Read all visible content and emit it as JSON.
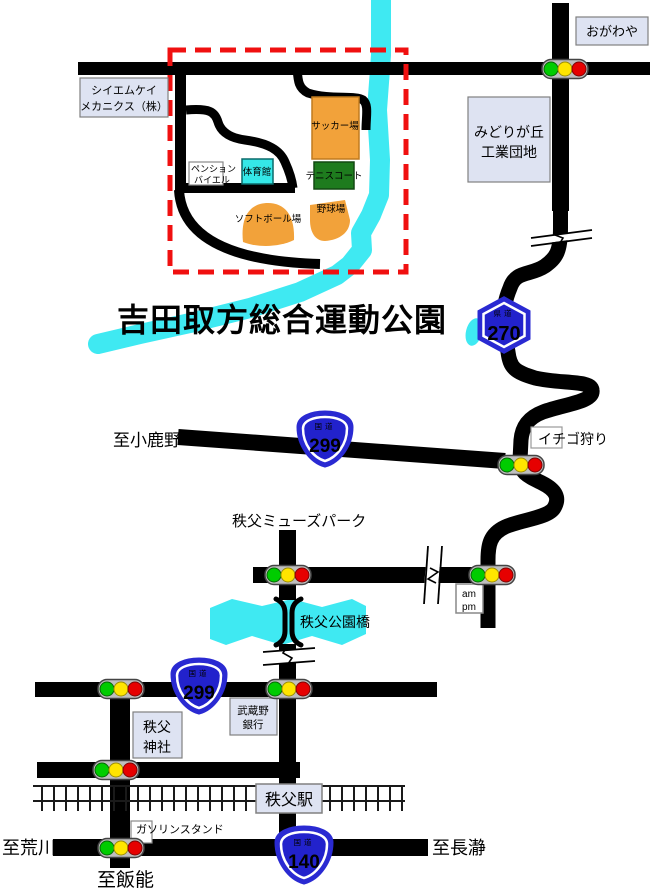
{
  "title": "吉田取方総合運動公園",
  "park": {
    "soccer_field": "サッカー場",
    "tennis_court": "テニスコート",
    "gymnasium": "体育館",
    "pension_line1": "ペンション",
    "pension_line2": "バイエル",
    "softball_field": "ソフトボール場",
    "baseball_field": "野球場"
  },
  "landmarks": {
    "cmk_line1": "シイエムケイ",
    "cmk_line2": "メカニクス（株）",
    "ogawaya": "おがわや",
    "midorigaoka_line1": "みどりが丘",
    "midorigaoka_line2": "工業団地",
    "strawberry": "イチゴ狩り",
    "muse_park": "秩父ミューズパーク",
    "park_bridge": "秩父公園橋",
    "ampm_line1": "am",
    "ampm_line2": "pm",
    "bank_line1": "武蔵野",
    "bank_line2": "銀行",
    "shrine_line1": "秩父",
    "shrine_line2": "神社",
    "station": "秩父駅",
    "gas_station": "ガソリンスタンド"
  },
  "destinations": {
    "ogano": "至小鹿野",
    "arakawa": "至荒川",
    "nagatoro": "至長瀞",
    "hanno": "至飯能"
  },
  "route_shields": {
    "prefectural_label": "県道",
    "national_label": "国道",
    "r270": "270",
    "r299": "299",
    "r140": "140"
  },
  "colors": {
    "road": "#000000",
    "river": "#3FE9F2",
    "park_boundary_dash": "#F01010",
    "title_text": "#1A1AC8",
    "shield_blue": "#2222CC",
    "facility_orange": "#F2A23A",
    "tennis_green": "#1E7B1E",
    "gym_cyan": "#35E8E8",
    "label_box_fill": "#DEE3F2",
    "signal_green": "#00CC00",
    "signal_yellow": "#FFE500",
    "signal_red": "#E60000"
  }
}
